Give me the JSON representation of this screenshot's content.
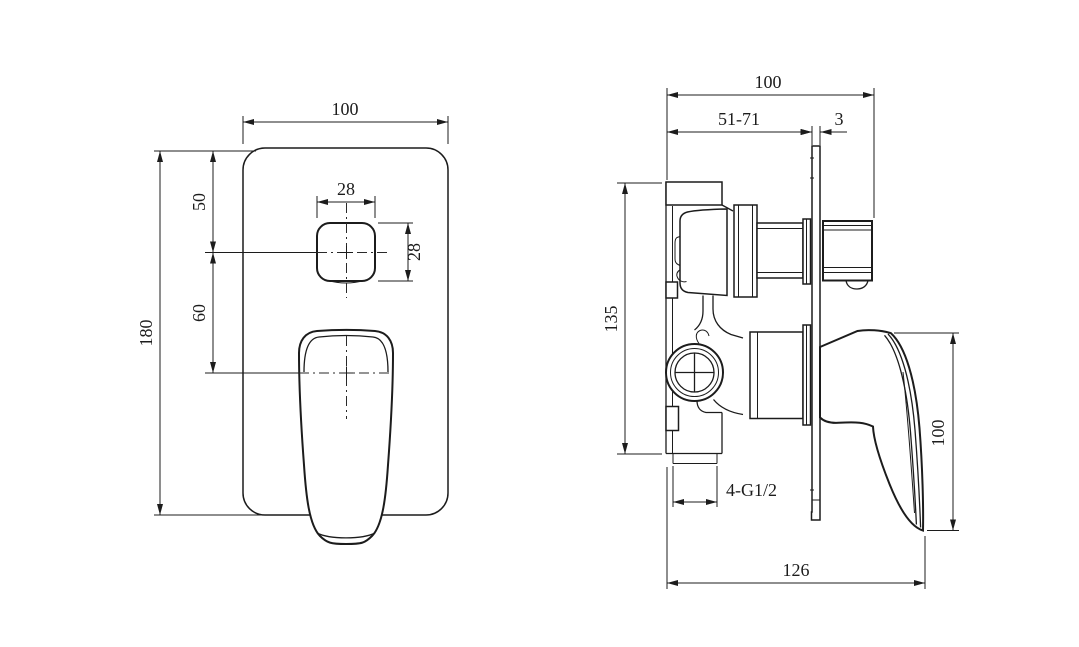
{
  "drawing": {
    "type": "technical-dimension-drawing",
    "subject": "concealed shower mixer valve, front and side views",
    "background_color": "#ffffff",
    "line_color": "#1c1c1c",
    "views": {
      "front": {
        "name": "front-view",
        "dims": {
          "plate_width": "100",
          "plate_height": "180",
          "top_to_knob_center": "50",
          "knob_center_to_handle_center": "60",
          "knob_width": "28",
          "knob_height": "28"
        }
      },
      "side": {
        "name": "side-view",
        "dims": {
          "total_depth": "100",
          "install_depth_range": "51-71",
          "plate_thickness": "3",
          "valve_body_height": "135",
          "handle_height": "100",
          "total_projection": "126",
          "connection_thread": "4-G1/2"
        }
      }
    }
  }
}
